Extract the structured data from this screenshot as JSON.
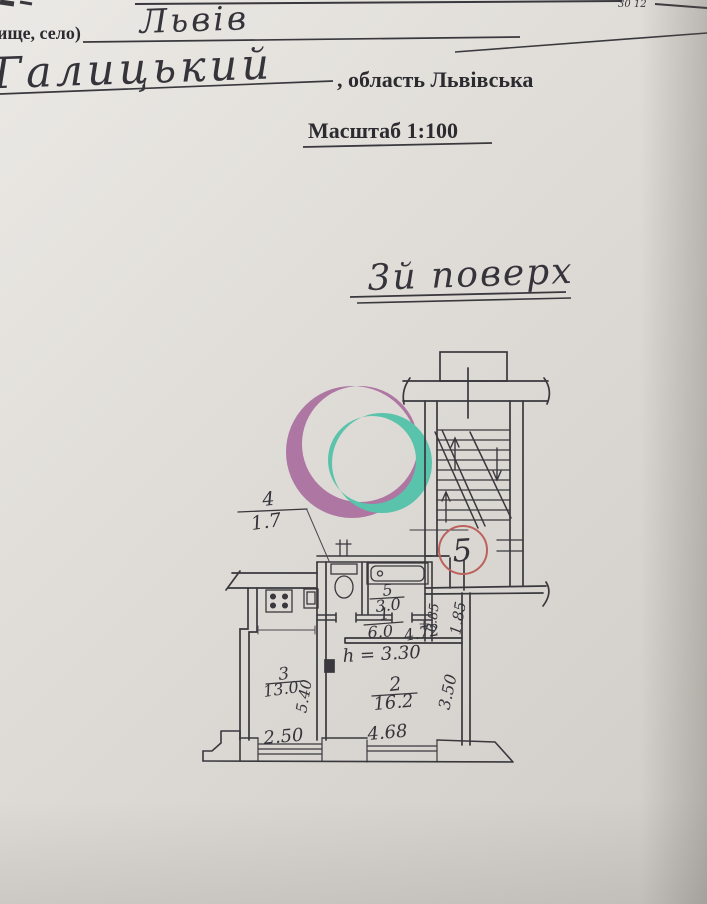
{
  "document": {
    "form": {
      "settlement_label": "ище, село)",
      "settlement_value": "Львів",
      "district_value": "Галицький",
      "oblast_label": ", область Львівська",
      "scale_label": "Масштаб 1:100",
      "corner_fragment": "30 12"
    },
    "floor_title": "3й поверх",
    "apartment_number": "5"
  },
  "plan": {
    "height_note": "h = 3.30",
    "rooms": [
      {
        "number": "1",
        "area": "6.0"
      },
      {
        "number": "2",
        "area": "16.2"
      },
      {
        "number": "3",
        "area": "13.0"
      },
      {
        "number": "4",
        "area": "1.7"
      },
      {
        "number": "5",
        "area": "3.0"
      }
    ],
    "dimensions": {
      "room3_width": "2.50",
      "room3_depth": "5.40",
      "room2_width": "4.68",
      "room2_depth": "3.50",
      "corridor_length": "4.72",
      "entry_width_a": "0.85",
      "entry_width_b": "1.85"
    }
  },
  "colors": {
    "red": "#bd615c",
    "logo_purple": "#a8699b",
    "logo_teal": "#49c0a6",
    "ink": "#39383d"
  }
}
